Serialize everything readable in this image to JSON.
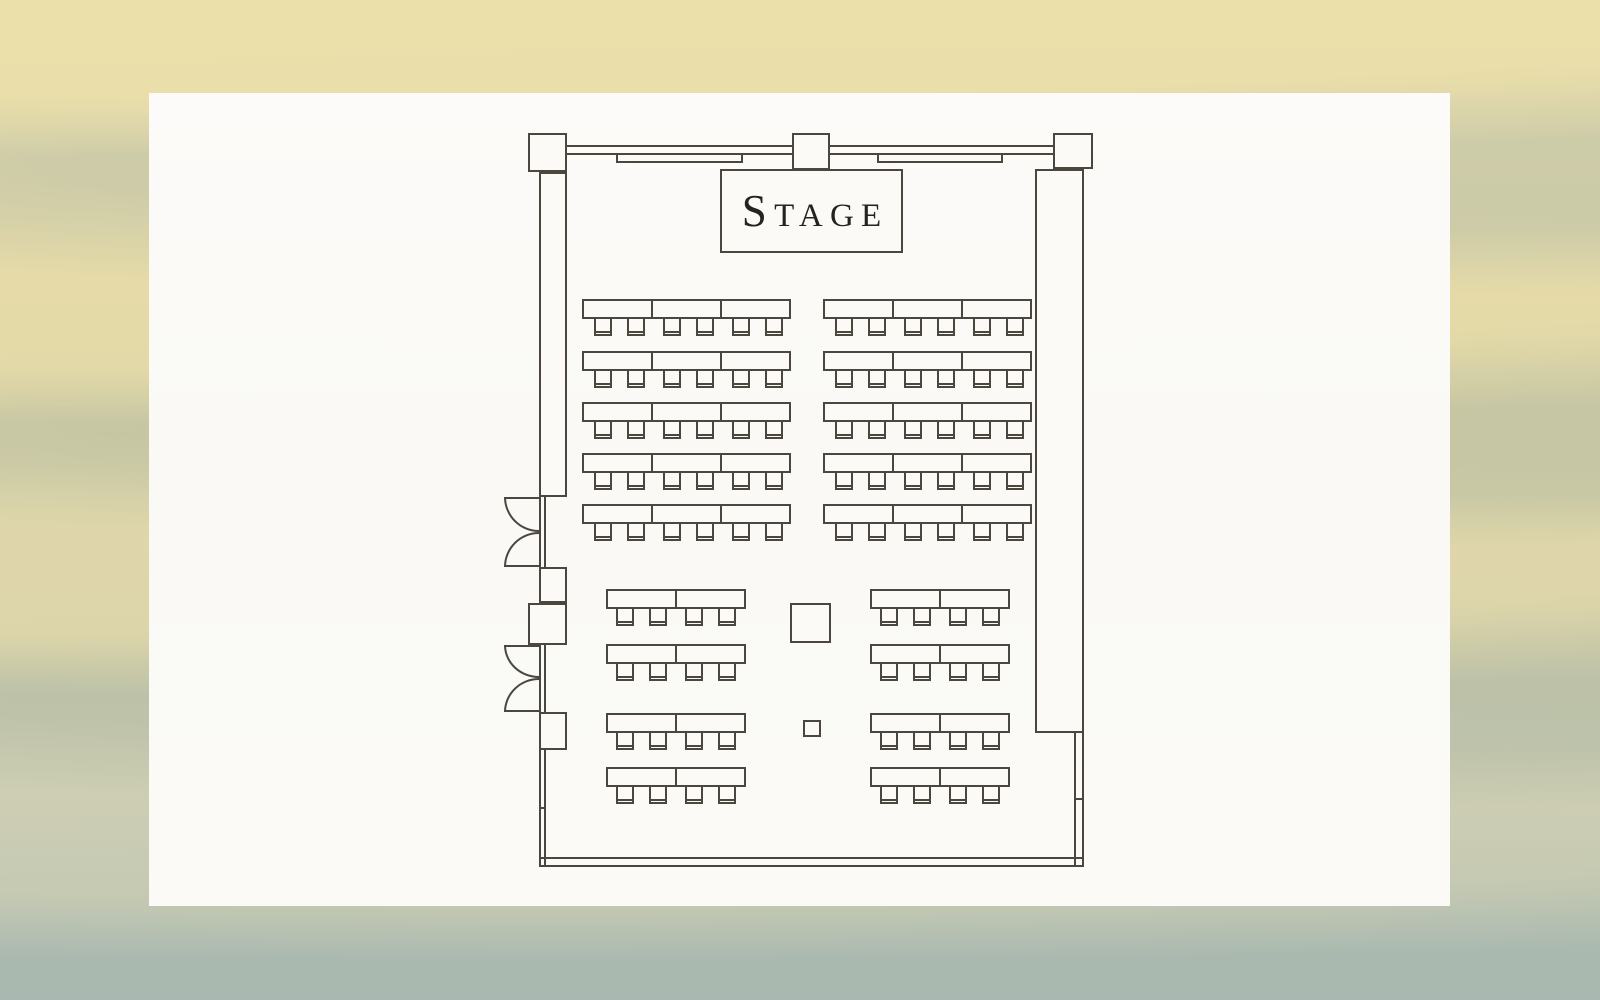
{
  "theme": {
    "line_color": "#4b463e",
    "card_color": "#fbfaf7",
    "stage_text_color": "#26231e",
    "background_tan": "#e7dcaa",
    "background_sage": "#bcc3b2"
  },
  "floor_plan": {
    "stage_label": "STAGE",
    "layout_style": "classroom",
    "sections": [
      {
        "name": "front-left",
        "x": 582,
        "row_ys": [
          299,
          351,
          402,
          453,
          504
        ],
        "tables_per_row": 3,
        "chairs_per_table": 2,
        "table_w": 71,
        "table_h": 20,
        "chair_w": 18,
        "chair_h": 17,
        "chair_offsets": [
          12,
          45
        ]
      },
      {
        "name": "front-right",
        "x": 823,
        "row_ys": [
          299,
          351,
          402,
          453,
          504
        ],
        "tables_per_row": 3,
        "chairs_per_table": 2,
        "table_w": 71,
        "table_h": 20,
        "chair_w": 18,
        "chair_h": 17,
        "chair_offsets": [
          12,
          45
        ]
      },
      {
        "name": "rear-left",
        "x": 606,
        "row_ys": [
          589,
          644,
          713,
          767
        ],
        "tables_per_row": 2,
        "chairs_per_table": 2,
        "table_w": 71,
        "table_h": 20,
        "chair_w": 18,
        "chair_h": 17,
        "chair_offsets": [
          10,
          43
        ]
      },
      {
        "name": "rear-right",
        "x": 870,
        "row_ys": [
          589,
          644,
          713,
          767
        ],
        "tables_per_row": 2,
        "chairs_per_table": 2,
        "table_w": 71,
        "table_h": 20,
        "chair_w": 18,
        "chair_h": 17,
        "chair_offsets": [
          10,
          43
        ]
      }
    ],
    "floor_objects": [
      {
        "name": "floor-object-square-large",
        "x": 790,
        "y": 603,
        "w": 41,
        "h": 40
      },
      {
        "name": "floor-object-square-small",
        "x": 803,
        "y": 720,
        "w": 18,
        "h": 17
      }
    ]
  }
}
